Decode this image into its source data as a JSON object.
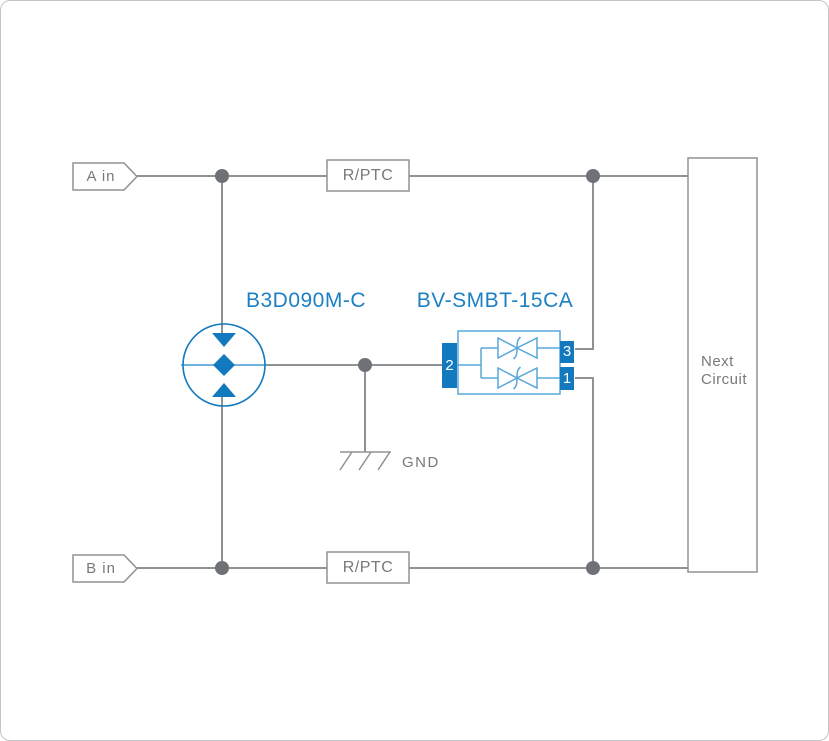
{
  "inputs": {
    "a_label": "A in",
    "b_label": "B in"
  },
  "resistors": {
    "top_label": "R/PTC",
    "bottom_label": "R/PTC"
  },
  "gdt": {
    "part_number": "B3D090M-C"
  },
  "tvs": {
    "part_number": "BV-SMBT-15CA",
    "pin2": "2",
    "pin3": "3",
    "pin1": "1"
  },
  "ground": {
    "label": "GND"
  },
  "next_circuit": {
    "line1": "Next",
    "line2": "Circuit"
  },
  "colors": {
    "accent_blue": "#1379be",
    "light_blue": "#58a7da",
    "label_blue": "#1b80c4",
    "wire_gray": "#8f9295",
    "dot_gray": "#6e7276",
    "text_gray": "#77797c",
    "box_fill": "#ffffff"
  }
}
